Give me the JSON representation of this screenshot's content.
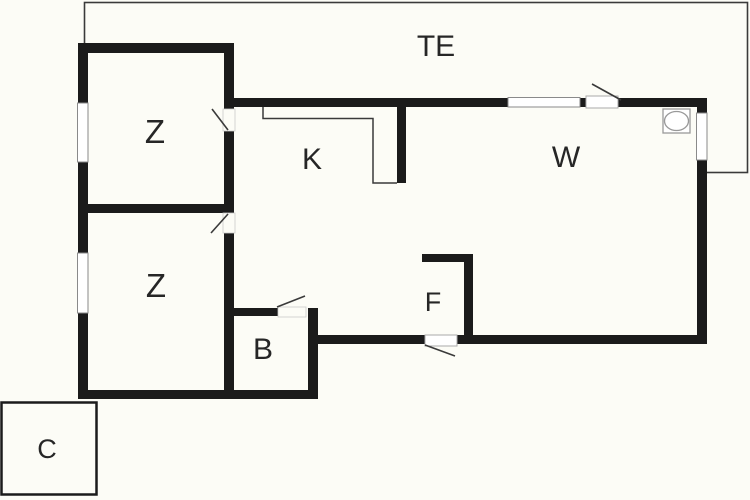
{
  "floorplan": {
    "colors": {
      "background": "#fcfcf6",
      "wall": "#1b1b1b",
      "thin_line": "#3a3a3a",
      "window_fill": "#ffffff",
      "label": "#262626"
    },
    "rooms": [
      {
        "id": "terrace",
        "label": "TE"
      },
      {
        "id": "bedroom-top",
        "label": "Z"
      },
      {
        "id": "bedroom-bottom",
        "label": "Z"
      },
      {
        "id": "kitchen",
        "label": "K"
      },
      {
        "id": "living-room",
        "label": "W"
      },
      {
        "id": "bathroom",
        "label": "B"
      },
      {
        "id": "entrance",
        "label": "F"
      },
      {
        "id": "carport",
        "label": "C"
      }
    ],
    "icons": [
      {
        "name": "stove-icon"
      }
    ]
  }
}
